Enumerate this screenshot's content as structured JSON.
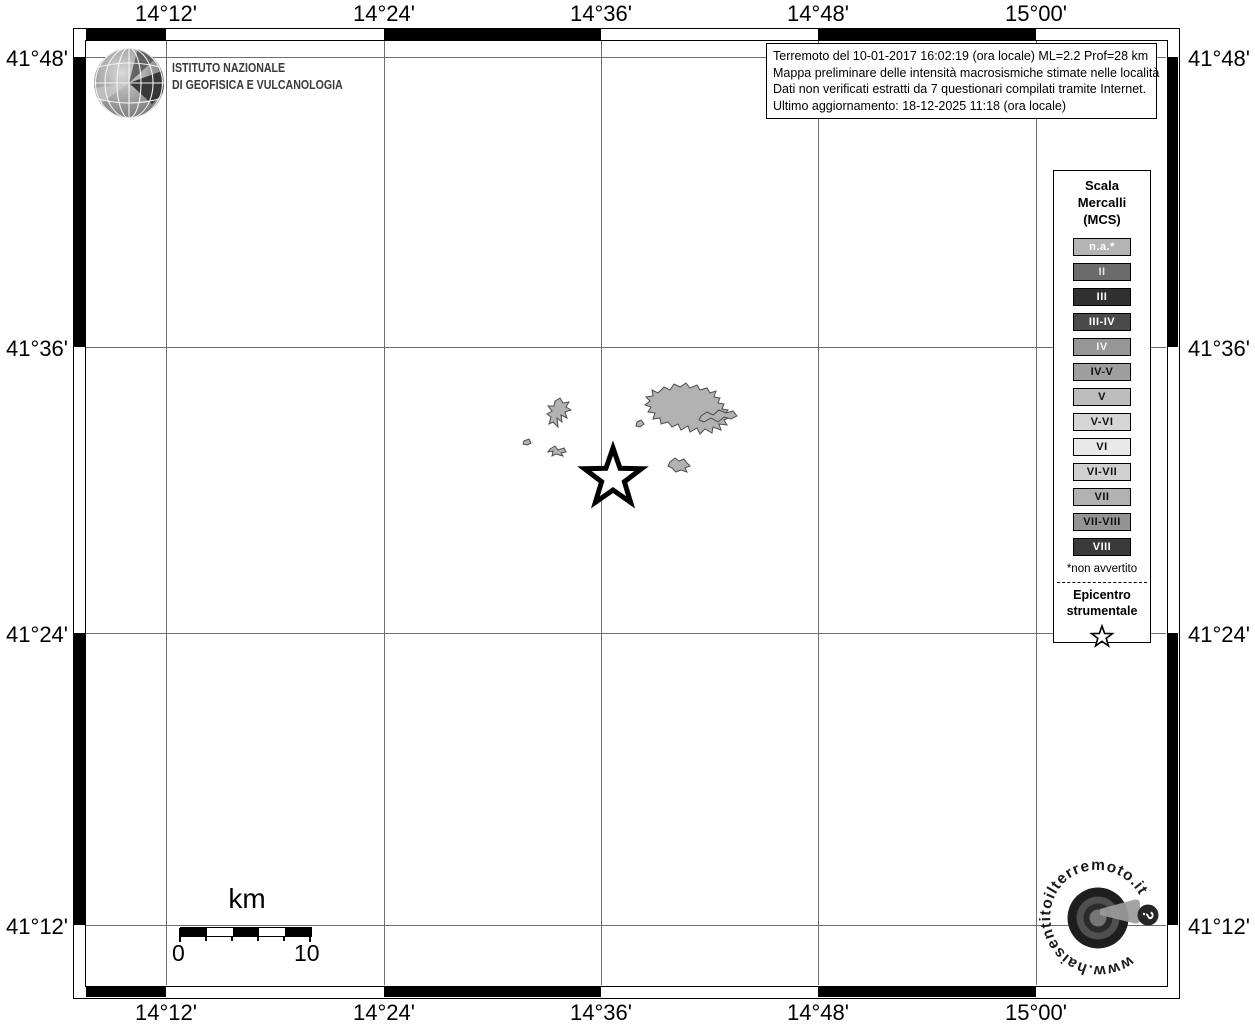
{
  "axis": {
    "lon_labels": [
      "14°12'",
      "14°24'",
      "14°36'",
      "14°48'",
      "15°00'"
    ],
    "lat_labels": [
      "41°48'",
      "41°36'",
      "41°24'",
      "41°12'"
    ]
  },
  "header": {
    "ingv_line1": "ISTITUTO NAZIONALE",
    "ingv_line2": "DI GEOFISICA E VULCANOLOGIA"
  },
  "info_box": {
    "line1": "Terremoto del 10-01-2017 16:02:19 (ora locale) ML=2.2 Prof=28 km",
    "line2": "Mappa preliminare delle intensità macrosismiche stimate nelle località",
    "line3": "Dati non verificati estratti da 7 questionari compilati tramite Internet.",
    "line4": "Ultimo aggiornamento: 18-12-2025 11:18 (ora locale)"
  },
  "legend": {
    "title": "Scala\nMercalli\n(MCS)",
    "items": [
      {
        "label": "n.a.*",
        "bg": "#b4b4b4",
        "fg": "#ffffff"
      },
      {
        "label": "II",
        "bg": "#6b6b6b",
        "fg": "#e6e6e6"
      },
      {
        "label": "III",
        "bg": "#303030",
        "fg": "#ffffff"
      },
      {
        "label": "III-IV",
        "bg": "#4a4a4a",
        "fg": "#ffffff"
      },
      {
        "label": "IV",
        "bg": "#969696",
        "fg": "#f2f2f2"
      },
      {
        "label": "IV-V",
        "bg": "#9e9e9e",
        "fg": "#101010"
      },
      {
        "label": "V",
        "bg": "#bdbdbd",
        "fg": "#101010"
      },
      {
        "label": "V-VI",
        "bg": "#d5d5d5",
        "fg": "#101010"
      },
      {
        "label": "VI",
        "bg": "#e9e9e9",
        "fg": "#101010"
      },
      {
        "label": "VI-VII",
        "bg": "#d0d0d0",
        "fg": "#101010"
      },
      {
        "label": "VII",
        "bg": "#b2b2b2",
        "fg": "#101010"
      },
      {
        "label": "VII-VIII",
        "bg": "#949494",
        "fg": "#101010"
      },
      {
        "label": "VIII",
        "bg": "#3a3a3a",
        "fg": "#ffffff"
      }
    ],
    "footnote": "*non avvertito",
    "epicenter_title": "Epicentro\nstrumentale"
  },
  "scale_bar": {
    "unit": "km",
    "start": "0",
    "end": "10"
  },
  "footer_logo": {
    "url_text": "www.haisentitoilterremoto.it",
    "question_mark": "?"
  },
  "map": {
    "locality_fill": "#b2b2b2",
    "locality_stroke": "#4d4d4d",
    "grid_color": "#6e6e6e",
    "epicenter_marker": "star"
  }
}
